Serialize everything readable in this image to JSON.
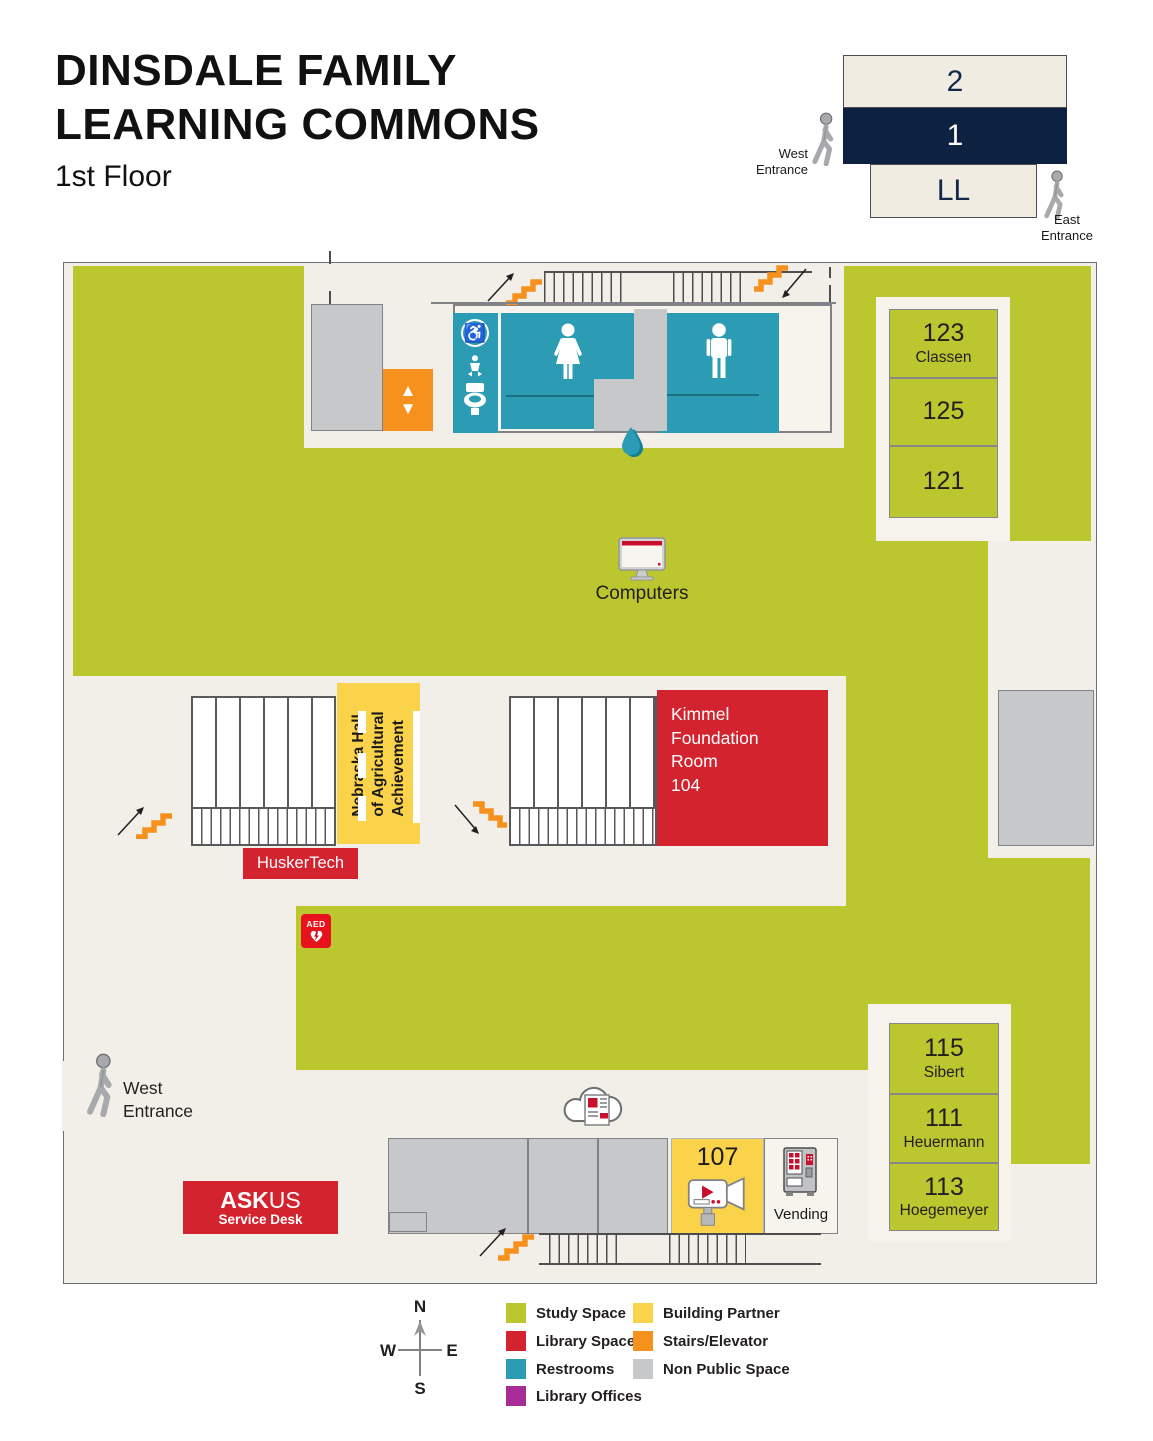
{
  "title": {
    "line1": "DINSDALE FAMILY",
    "line2": "LEARNING COMMONS",
    "subtitle": "1st Floor"
  },
  "floor_selector": {
    "floor_2": "2",
    "floor_1": "1",
    "floor_ll": "LL",
    "west_entrance": "West\nEntrance",
    "east_entrance": "East\nEntrance"
  },
  "map": {
    "rooms": {
      "r123": {
        "number": "123",
        "name": "Classen"
      },
      "r125": {
        "number": "125"
      },
      "r121": {
        "number": "121"
      },
      "r115": {
        "number": "115",
        "name": "Sibert"
      },
      "r111": {
        "number": "111",
        "name": "Heuermann"
      },
      "r113": {
        "number": "113",
        "name": "Hoegemeyer"
      },
      "r107": {
        "number": "107"
      },
      "r104": {
        "label": "Kimmel\nFoundation\nRoom\n104"
      }
    },
    "labels": {
      "computers": "Computers",
      "nebraska_hall": "Nebraska Hall\nof Agricultural\nAchievement",
      "huskertech": "HuskerTech",
      "vending": "Vending",
      "aed": "AED",
      "west_entrance": "West\nEntrance",
      "ask_bold": "ASK",
      "ask_light": "US",
      "service_desk": "Service Desk"
    }
  },
  "icons": {
    "accessible": "♿",
    "elevator_up": "▲",
    "elevator_down": "▼"
  },
  "legend": {
    "column1": [
      {
        "label": "Study Space",
        "color": "#bcc62f"
      },
      {
        "label": "Library Space",
        "color": "#d2232f"
      },
      {
        "label": "Restrooms",
        "color": "#2b9cb4"
      },
      {
        "label": "Library Offices",
        "color": "#a82c98"
      }
    ],
    "column2": [
      {
        "label": "Building Partner",
        "color": "#fbd34b"
      },
      {
        "label": "Stairs/Elevator",
        "color": "#f6911e"
      },
      {
        "label": "Non Public Space",
        "color": "#c6c8ca"
      }
    ]
  },
  "compass": {
    "north": "N",
    "south": "S",
    "east": "E",
    "west": "W"
  },
  "colors": {
    "study_space": "#bcc62f",
    "library_space": "#d2232f",
    "restrooms": "#2b9cb4",
    "library_offices": "#a82c98",
    "building_partner": "#fbd34b",
    "stairs_elevator": "#f6911e",
    "non_public": "#c6c8ca",
    "selected_floor": "#0d2240",
    "map_background": "#f2efe8"
  }
}
